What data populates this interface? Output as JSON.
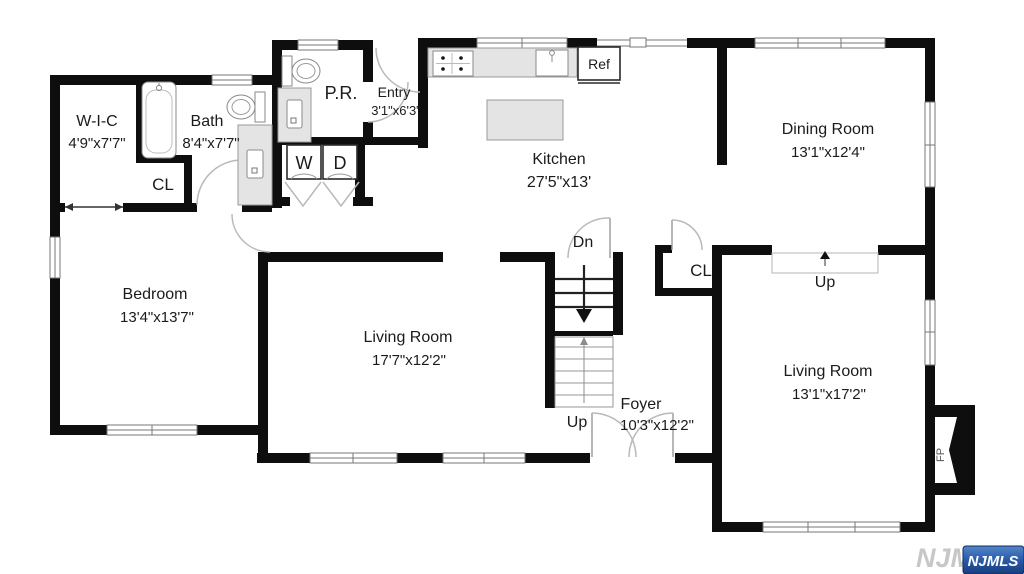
{
  "rooms": {
    "wic": {
      "name": "W-I-C",
      "dims": "4'9\"x7'7\""
    },
    "bath": {
      "name": "Bath",
      "dims": "8'4\"x7'7\""
    },
    "entry": {
      "name": "Entry",
      "dims": "3'1\"x6'3\""
    },
    "kitchen": {
      "name": "Kitchen",
      "dims": "27'5\"x13'"
    },
    "dining": {
      "name": "Dining Room",
      "dims": "13'1\"x12'4\""
    },
    "bedroom": {
      "name": "Bedroom",
      "dims": "13'4\"x13'7\""
    },
    "living_left": {
      "name": "Living Room",
      "dims": "17'7\"x12'2\""
    },
    "foyer": {
      "name": "Foyer",
      "dims": "10'3\"x12'2\""
    },
    "living_right": {
      "name": "Living Room",
      "dims": "13'1\"x17'2\""
    }
  },
  "labels": {
    "pr": "P.R.",
    "cl": "CL",
    "washer": "W",
    "dryer": "D",
    "ref": "Ref",
    "dn": "Dn",
    "up": "Up",
    "fp": "FP"
  },
  "watermark": {
    "text": "NJMLS",
    "badge": "NJMLS",
    "badge_color": "#1c4a94"
  },
  "colors": {
    "wall": "#0e0e0e",
    "fixture": "#e4e4e4",
    "background": "#ffffff"
  }
}
